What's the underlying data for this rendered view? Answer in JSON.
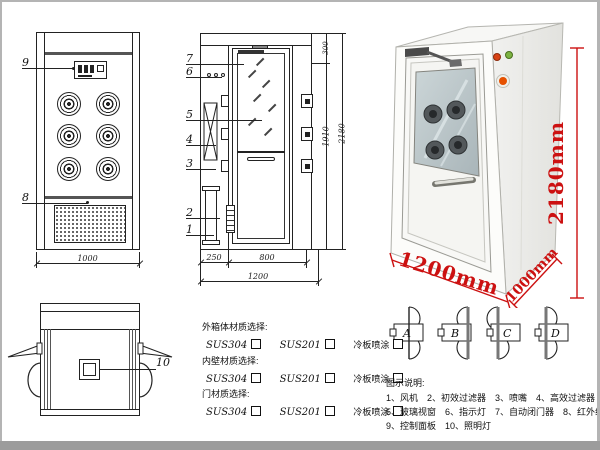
{
  "front_view": {
    "callout_9": "9",
    "callout_8": "8",
    "width_dim": "1000"
  },
  "side_view": {
    "callouts": {
      "c7": "7",
      "c6": "6",
      "c5": "5",
      "c4": "4",
      "c3": "3",
      "c2": "2",
      "c1": "1"
    },
    "dim_top": "300",
    "dim_inner_height": "1910",
    "dim_total_height": "2180",
    "dim_left": "250",
    "dim_door": "800",
    "dim_total_width": "1200"
  },
  "top_view": {
    "callout_10": "10"
  },
  "photo": {
    "dim_height": "2180mm",
    "dim_width": "1200mm",
    "dim_depth": "1000mm",
    "accent": "#cc1111"
  },
  "door_options": {
    "a": "A",
    "b": "B",
    "c": "C",
    "d": "D"
  },
  "materials": {
    "groups": [
      {
        "title": "外箱体材质选择:",
        "options": [
          "SUS304",
          "SUS201",
          "冷板喷涂"
        ]
      },
      {
        "title": "内壁材质选择:",
        "options": [
          "SUS304",
          "SUS201",
          "冷板喷涂"
        ]
      },
      {
        "title": "门材质选择:",
        "options": [
          "SUS304",
          "SUS201",
          "冷板喷涂"
        ]
      }
    ]
  },
  "legend": {
    "title": "图示说明:",
    "line1": [
      "1、风机",
      "2、初效过滤器",
      "3、喷嘴",
      "4、高效过滤器"
    ],
    "line2": [
      "5、玻璃视窗",
      "6、指示灯",
      "7、自动闭门器",
      "8、红外线感应器"
    ],
    "line3": [
      "9、控制面板",
      "10、照明灯"
    ]
  }
}
